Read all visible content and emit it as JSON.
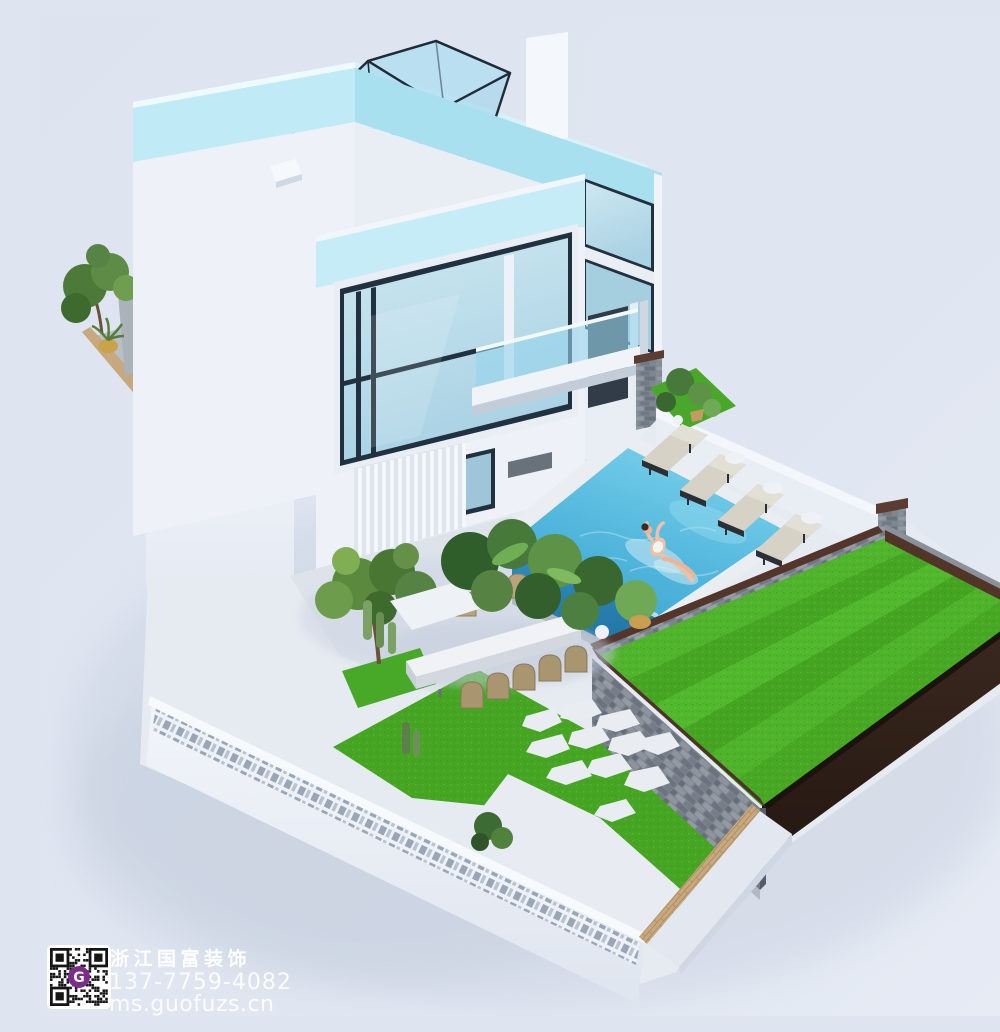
{
  "watermark": {
    "company_name": "浙江国富装饰",
    "phone": "137-7759-4082",
    "website": "ms.guofuzs.cn",
    "qr_logo_letter": "G"
  },
  "scene": {
    "type": "3d-architectural-rendering",
    "description": "Aerial isometric rendering of a modern three-story white villa: cyan-edged roof deck with a framed glass skylight wedge, tall glass curtain-wall windows, a balcony with glass railing, a backyard swimming pool with a woman floating on a clear float, four cushioned sun loungers along a white wall, a long outdoor dining table with ten chairs and a tree, lush planting and cacti, a raised striped lawn shown as a cut-away with dark soil, stacked-stone retaining walls with dark timber caps, a lower lawn with stepping stones, and a perforated white perimeter wall with tan brick banding",
    "objects": [
      "villa-building",
      "roof-deck",
      "glass-skylight",
      "stair-shaft",
      "balcony",
      "curtain-wall-window",
      "louver-screen",
      "swimming-pool",
      "woman-on-float",
      "sun-loungers",
      "side-tables",
      "dining-table",
      "dining-chairs",
      "courtyard-tree",
      "planted-terrace",
      "raised-lawn",
      "soil-cross-section",
      "stone-retaining-wall",
      "lower-lawn",
      "stepping-stones",
      "perimeter-wall",
      "qr-watermark"
    ],
    "palette": {
      "background": "#dfe5f0",
      "white_wall": "#eef2f8",
      "roof_cyan": "#c0eaf6",
      "roof_cyan_dark": "#a9e0f0",
      "glass": "#bdddeb",
      "frame_dark": "#22313f",
      "pool_water": "#55b9de",
      "pool_deep": "#2f8fc0",
      "grass": "#4db52b",
      "grass_dark": "#46a623",
      "soil": "#38261d",
      "stone_wall": "#848c96",
      "stone_cap": "#4e332a",
      "tan_brick": "#c8a87e",
      "lounger_cushion": "#d6d2c6",
      "chair_wood": "#b3a17e",
      "qr_logo_purple": "#7b2d8b"
    }
  }
}
